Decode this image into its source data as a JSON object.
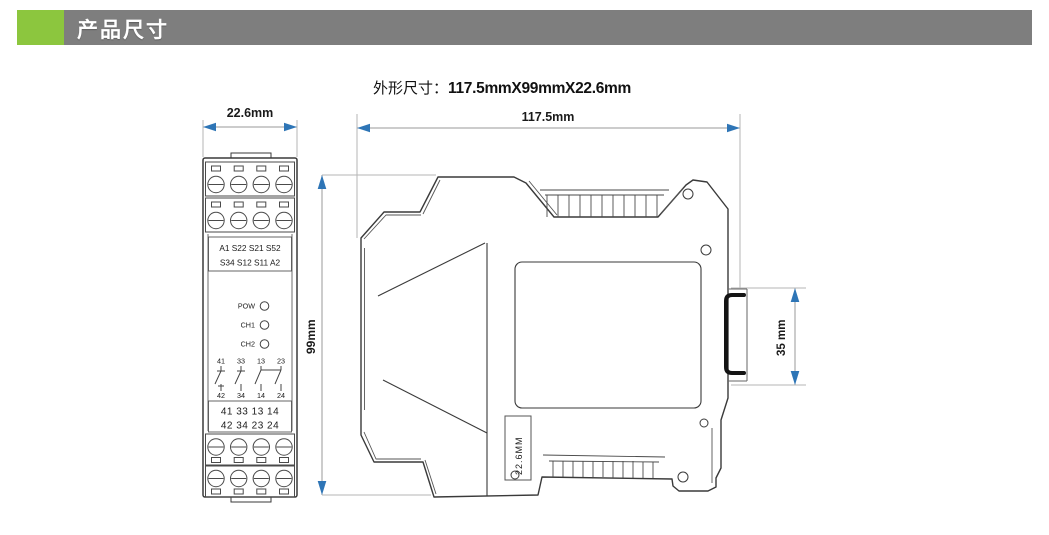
{
  "header": {
    "title": "产品尺寸"
  },
  "subtitle": {
    "label": "外形尺寸：",
    "value": "117.5mmX99mmX22.6mm"
  },
  "front_view": {
    "width_dim": "22.6mm",
    "terminal_box_rows": [
      "A1 S22 S21 S52",
      "S34 S12 S11 A2"
    ],
    "led_labels": [
      "POW",
      "CH1",
      "CH2"
    ],
    "contact_top_nums": [
      "41",
      "33",
      "13",
      "23"
    ],
    "contact_bottom_nums": [
      "42",
      "34",
      "14",
      "24"
    ],
    "lower_box_rows": [
      "41 33 13 14",
      "42 34 23 24"
    ]
  },
  "side_view": {
    "length_dim": "117.5mm",
    "height_dim": "99mm",
    "rail_dim": "35 mm",
    "depth_label": "22.6MM"
  },
  "colors": {
    "header_bar": "#7e7e7e",
    "accent_green": "#8cc63e",
    "arrow_blue": "#2e75b6",
    "line_dark": "#3a3a3a",
    "dim_line": "#9a9a9a"
  }
}
